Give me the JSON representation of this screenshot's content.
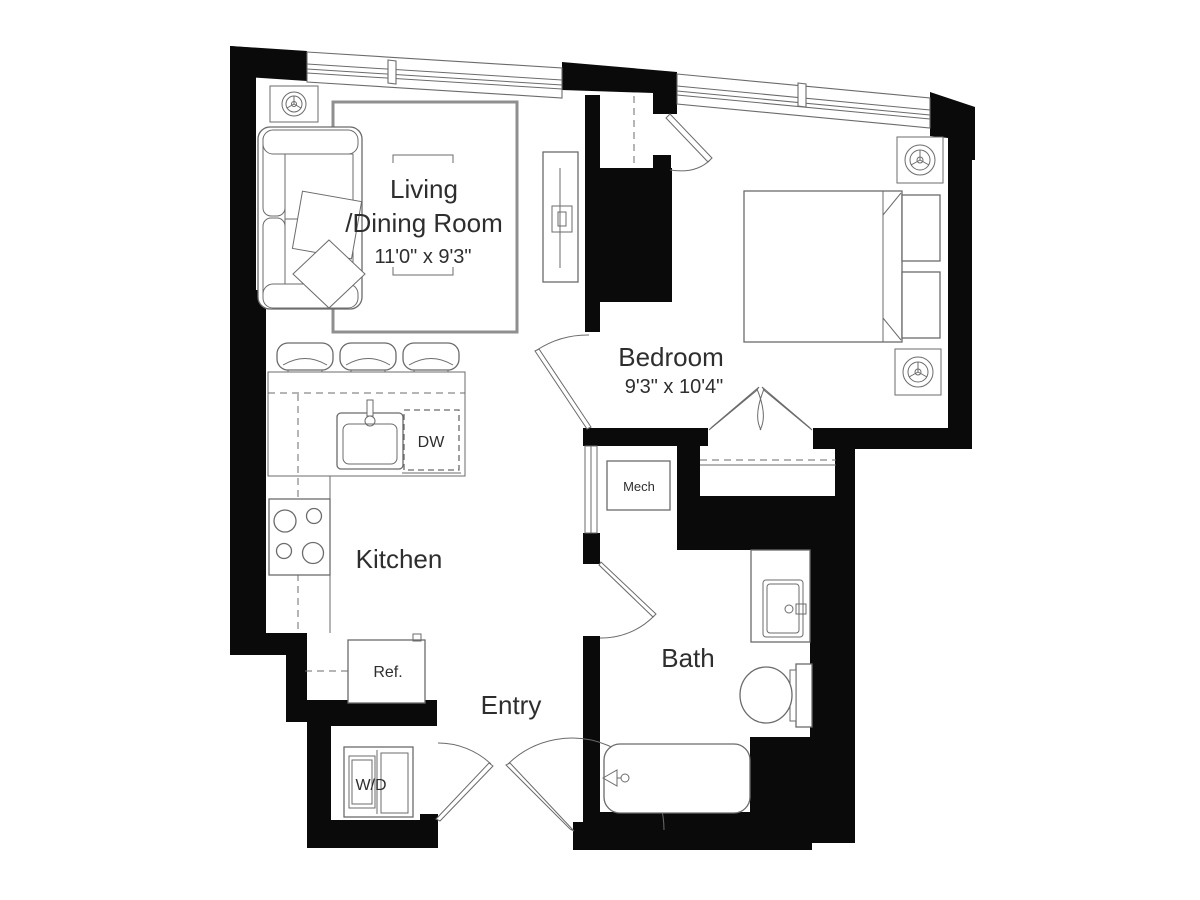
{
  "plan": {
    "rooms": {
      "living": {
        "name_line1": "Living",
        "name_line2": "/Dining Room",
        "dimensions": "11'0\" x 9'3\""
      },
      "bedroom": {
        "name": "Bedroom",
        "dimensions": "9'3\" x 10'4\""
      },
      "kitchen": {
        "name": "Kitchen"
      },
      "bath": {
        "name": "Bath"
      },
      "entry": {
        "name": "Entry"
      }
    },
    "labels": {
      "mech": "Mech",
      "dishwasher": "DW",
      "refrigerator": "Ref.",
      "washer_dryer": "W/D"
    },
    "icons": [
      "sprinkler-icon"
    ],
    "colors": {
      "wall": "#0a0a0a",
      "line": "#6b6b6b",
      "line_light": "#8f8f8f",
      "text": "#2e2e2e",
      "background": "#ffffff"
    }
  }
}
